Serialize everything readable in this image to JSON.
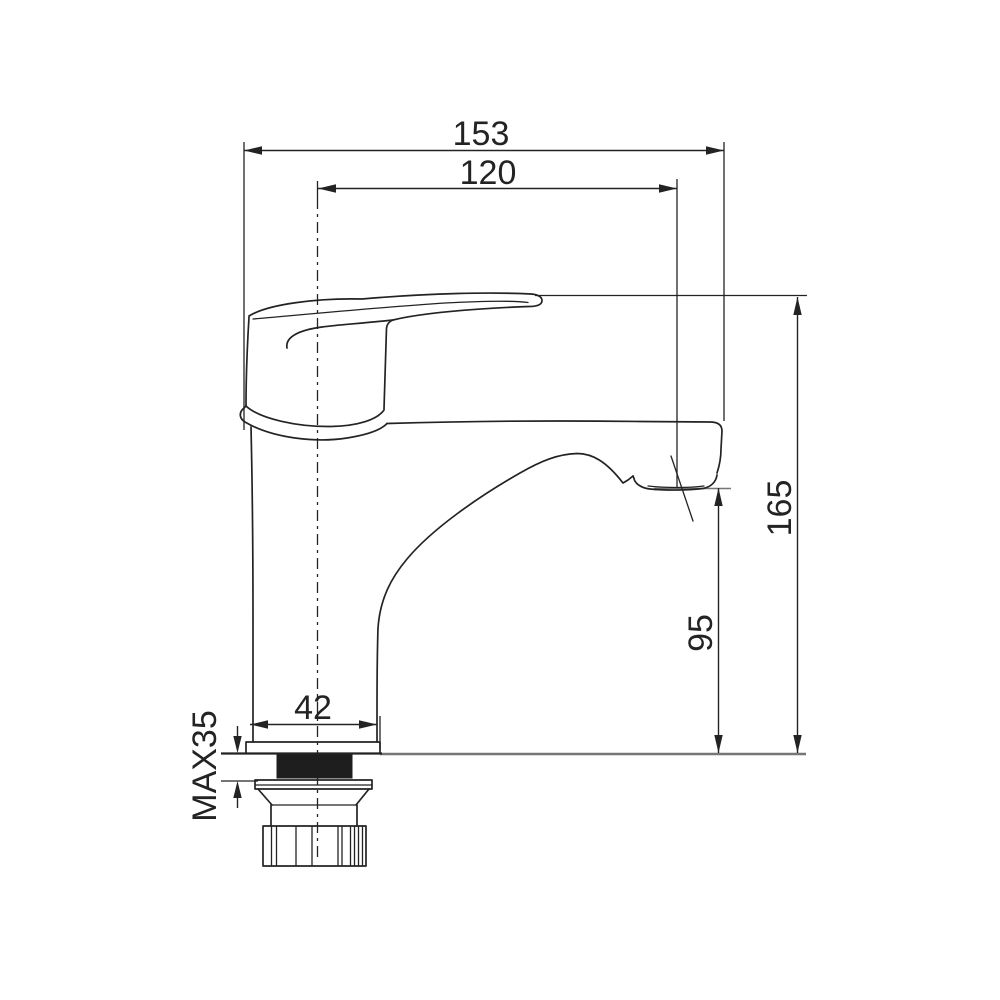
{
  "drawing": {
    "subject": "single-lever basin faucet side elevation with installation dimensions",
    "colors": {
      "line": "#232323",
      "reference_line": "#767676",
      "background": "#ffffff",
      "gasket_fill": "#1e1e1e"
    },
    "dimensions": {
      "overall_length": "153",
      "spout_reach": "120",
      "overall_height": "165",
      "spout_outlet_height": "95",
      "base_width": "42",
      "max_mounting_thickness": "MAX35"
    }
  }
}
